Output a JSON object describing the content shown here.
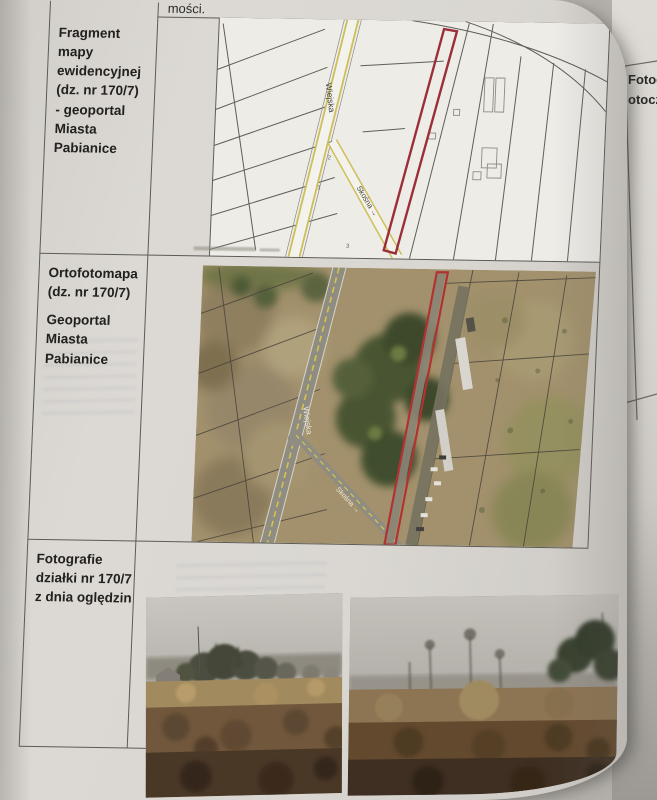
{
  "page": {
    "fragment_above": "mości.",
    "row1": {
      "l1": "Fragment mapy",
      "l2": "ewidencyjnej",
      "l3": "(dz. nr 170/7)",
      "l4": "- geoportal",
      "l5": "Miasta",
      "l6": "Pabianice"
    },
    "row2": {
      "l1": "Ortofotomapa",
      "l2": "(dz. nr 170/7)",
      "l3": "Geoportal",
      "l4": "Miasta",
      "l5": "Pabianice"
    },
    "row3": {
      "l1": "Fotografie",
      "l2": "działki nr 170/7",
      "l3": "z dnia oględzin"
    }
  },
  "map": {
    "street_wiejska": "Wiejska",
    "street_skosna": "Skośna →",
    "parcel_1": "1",
    "parcel_2": "2",
    "parcel_3": "3"
  },
  "ortho": {
    "street_wiejska": "Wiejska",
    "street_skosna": "Skośna →"
  },
  "next_page": {
    "l1": "Fotog",
    "l2": "otocz"
  },
  "colors": {
    "highlight_red": "#9a2f38",
    "ortho_red": "#b23232",
    "road_yellow": "#cdbf5a",
    "paper": "#dbd8d3"
  }
}
